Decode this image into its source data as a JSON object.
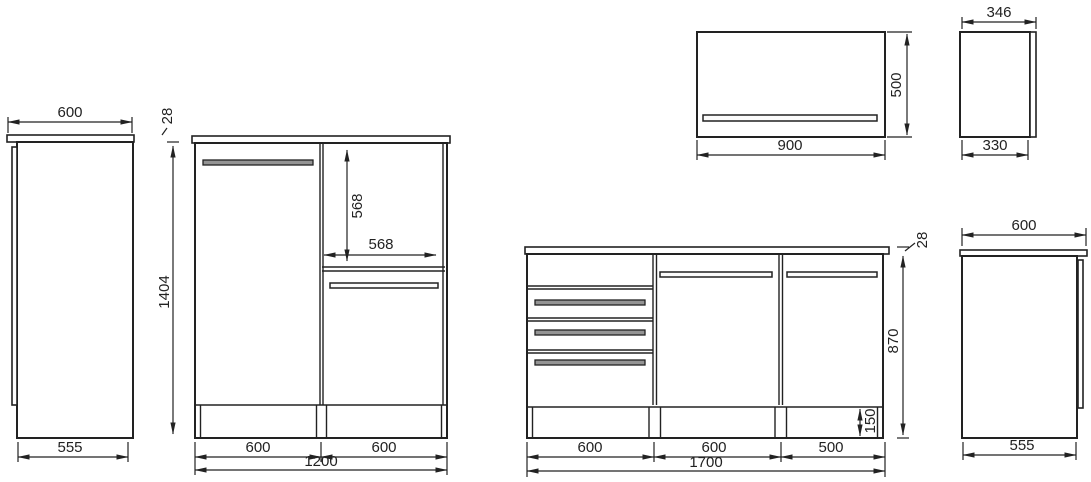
{
  "page": {
    "background": "#ffffff",
    "line_color": "#222222",
    "handle_fill_dark": "#949494",
    "handle_fill_light": "#fbfbfb"
  },
  "dimensions": {
    "tall_side_top_width": "600",
    "tall_side_bottom_depth": "555",
    "base1200_top_thickness": "28",
    "base1200_height": "1404",
    "base1200_niche_height": "568",
    "base1200_niche_width": "568",
    "base1200_section1_width": "600",
    "base1200_section2_width": "600",
    "base1200_total_width": "1200",
    "wall900_width": "900",
    "wall900_height": "500",
    "wall_side_top_depth": "346",
    "wall_side_bottom_depth": "330",
    "base1700_top_thickness": "28",
    "base1700_height": "870",
    "base1700_plinth_height": "150",
    "base1700_section1_width": "600",
    "base1700_section2_width": "600",
    "base1700_section3_width": "500",
    "base1700_total_width": "1700",
    "base_side_top_width": "600",
    "base_side_bottom_depth": "555"
  }
}
